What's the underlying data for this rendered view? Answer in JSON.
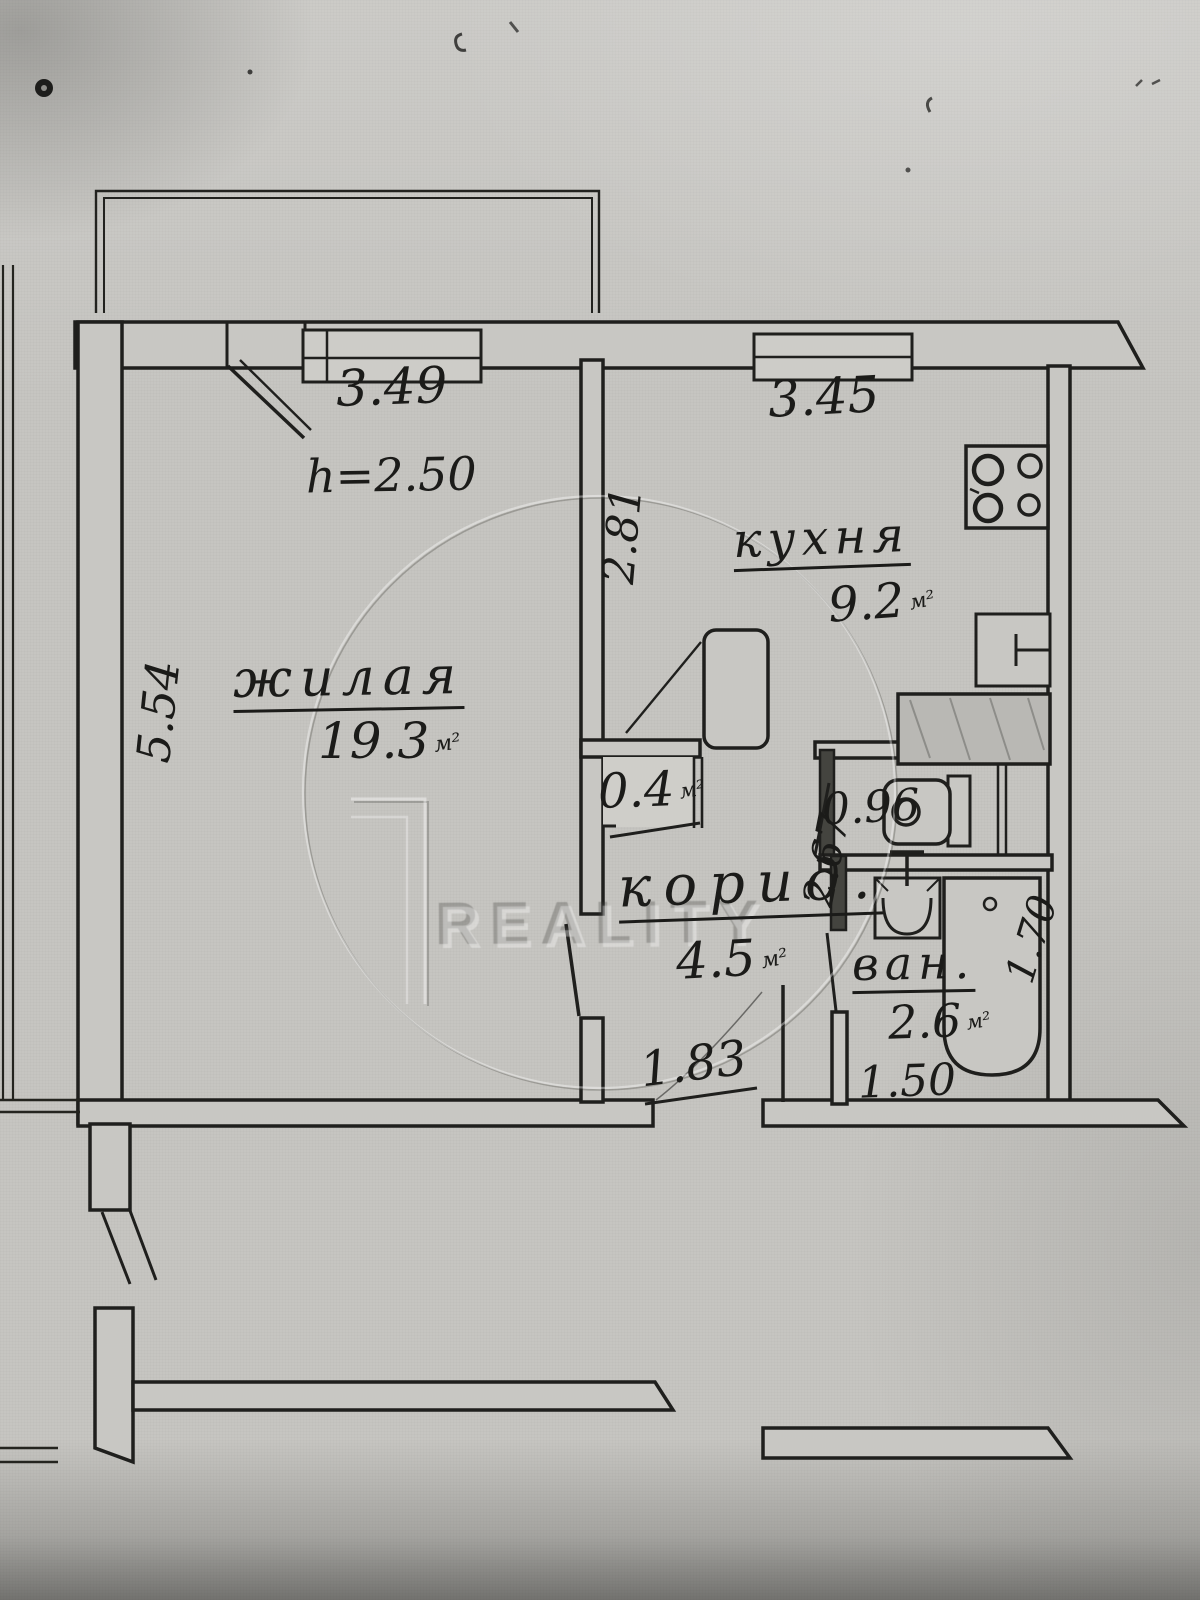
{
  "watermark": {
    "brand": "REALITY"
  },
  "unit_mark": "м²",
  "rooms": {
    "living": {
      "name": "жилая",
      "area": "19.3"
    },
    "kitchen": {
      "name": "кухня",
      "area": "9.2"
    },
    "corridor": {
      "name": "корид.",
      "area": "4.5"
    },
    "bathroom": {
      "name": "ван.",
      "area": "2.6"
    },
    "closet": {
      "area": "0.4"
    }
  },
  "dimensions": {
    "living_width": "3.49",
    "kitchen_width": "3.45",
    "ceiling_height": "h=2.50",
    "kitchen_depth": "2.81",
    "living_depth": "5.54",
    "corridor_depth": "2.67",
    "wc_width": "0.96",
    "bathtub_length": "1.70",
    "entry_wall": "1.83",
    "bathroom_width": "1.50"
  }
}
